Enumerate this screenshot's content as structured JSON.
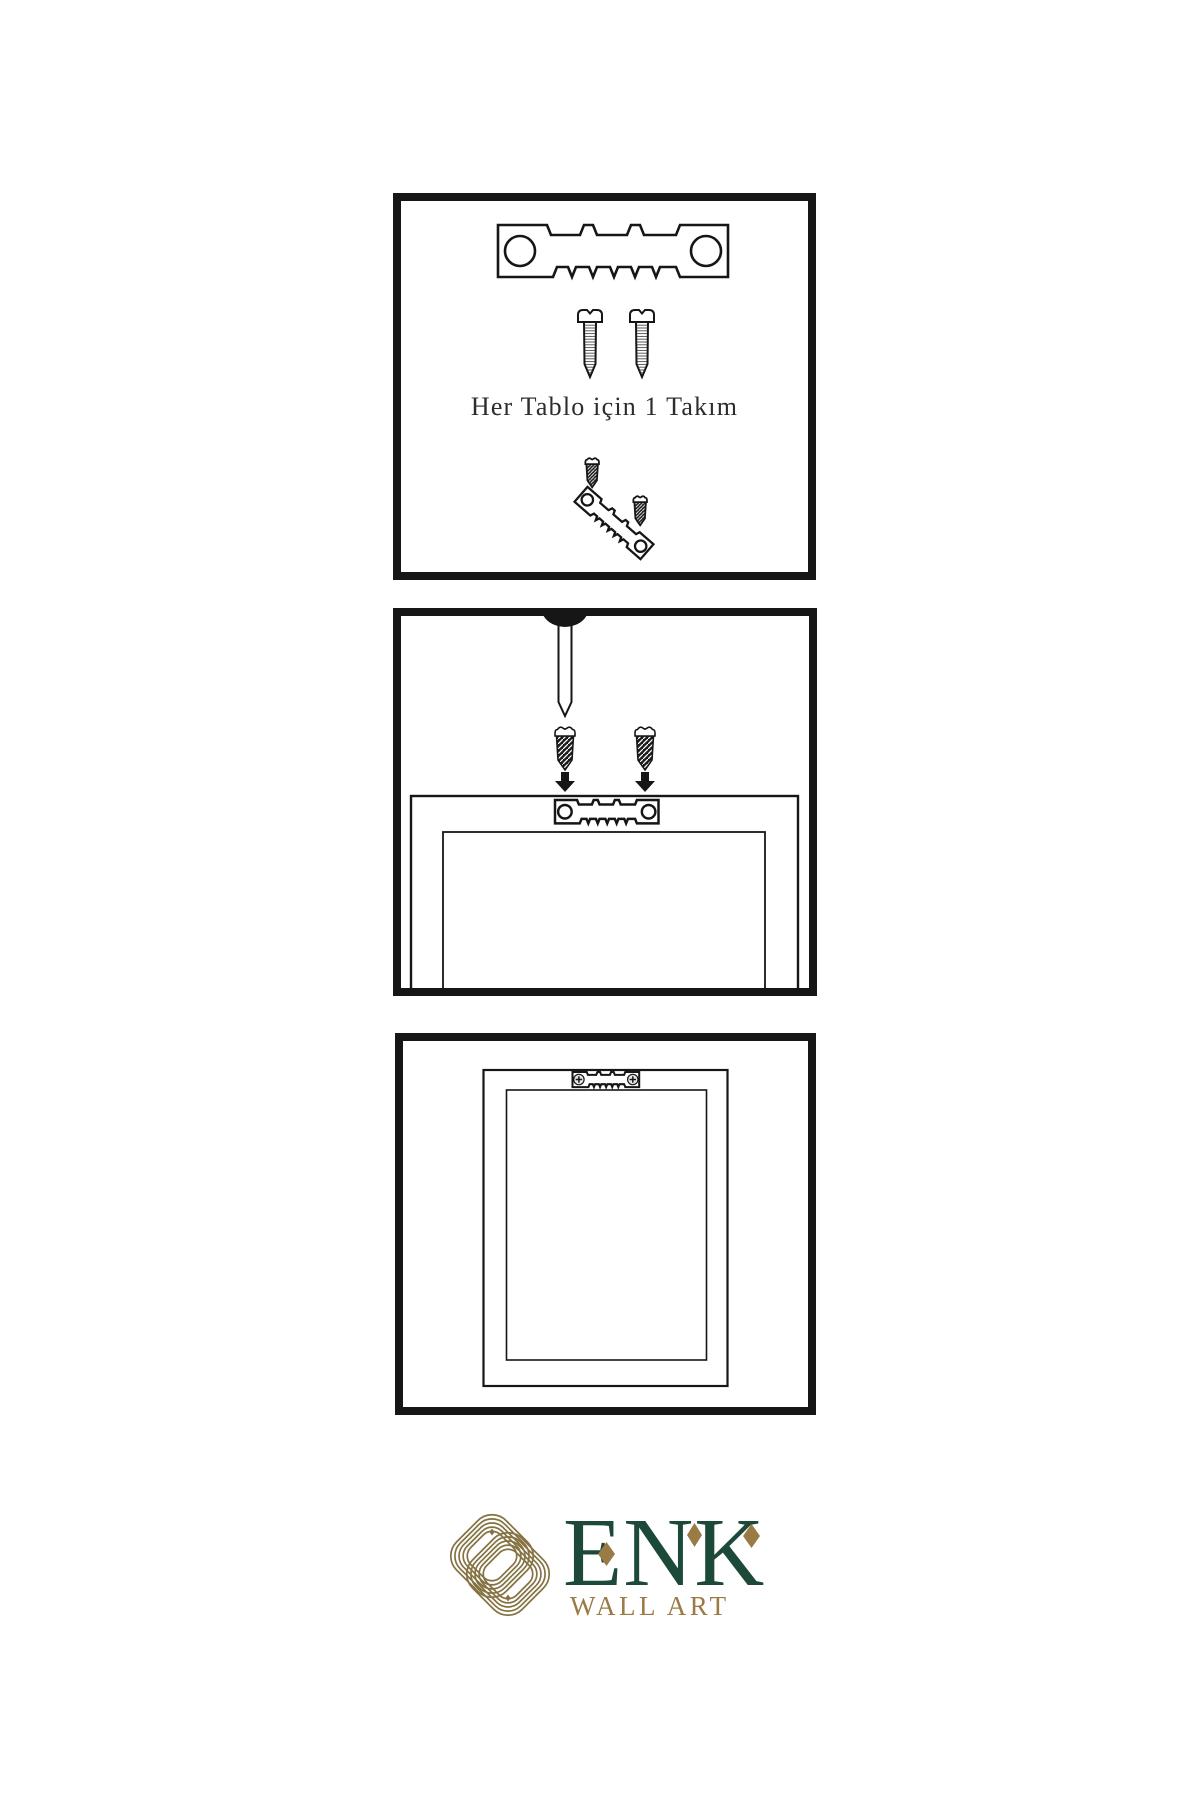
{
  "instructions": {
    "step1_caption": "Her Tablo için 1 Takım"
  },
  "logo": {
    "wordmark": "ENK",
    "subtitle": "WALL ART"
  },
  "colors": {
    "line": "#161616",
    "logo_green": "#1d4a38",
    "logo_gold": "#9a7b45",
    "knot_gold": "#857242"
  },
  "icons": {
    "sawtooth_hanger": "sawtooth-hanger-icon",
    "screw": "screw-icon",
    "dark_screw": "dark-screw-icon",
    "wall_nail": "wall-nail-icon",
    "down_arrow": "down-arrow-icon",
    "phillips_head": "phillips-screw-head-icon",
    "knot_monogram": "knot-monogram-icon"
  }
}
